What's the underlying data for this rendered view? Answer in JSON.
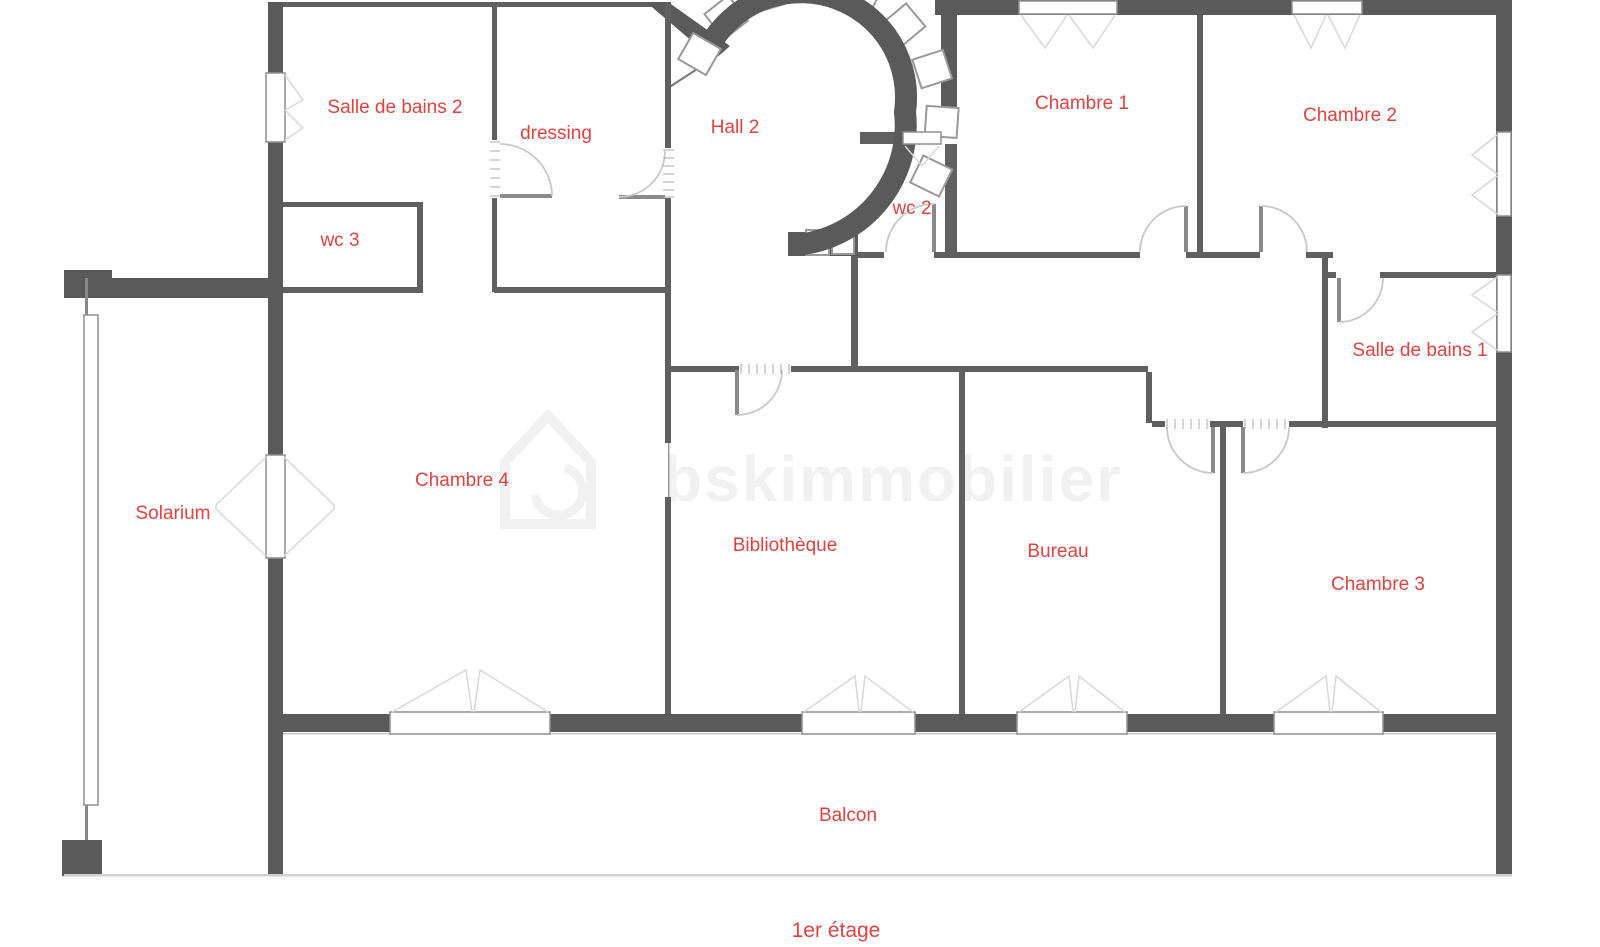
{
  "floor_plan": {
    "rooms": [
      {
        "id": "salle-de-bains-2",
        "label": "Salle de bains 2"
      },
      {
        "id": "dressing",
        "label": "dressing"
      },
      {
        "id": "hall-2",
        "label": "Hall 2"
      },
      {
        "id": "chambre-1",
        "label": "Chambre 1"
      },
      {
        "id": "chambre-2",
        "label": "Chambre 2"
      },
      {
        "id": "wc-3",
        "label": "wc 3"
      },
      {
        "id": "wc-2",
        "label": "wc 2"
      },
      {
        "id": "salle-de-bains-1",
        "label": "Salle de bains 1"
      },
      {
        "id": "chambre-4",
        "label": "Chambre 4"
      },
      {
        "id": "solarium",
        "label": "Solarium"
      },
      {
        "id": "bibliotheque",
        "label": "Bibliothèque"
      },
      {
        "id": "bureau",
        "label": "Bureau"
      },
      {
        "id": "chambre-3",
        "label": "Chambre 3"
      },
      {
        "id": "balcon",
        "label": "Balcon"
      }
    ],
    "floor_label": "1er étage",
    "watermark": "bskimmobilier",
    "colors": {
      "label": "#e04340",
      "wall": "#5a5a5a",
      "interior_wall": "#606060",
      "window_border": "#8f8f8f",
      "door_arc": "#c8c8c8",
      "watermark": "#f1f1f1",
      "background": "#ffffff"
    }
  }
}
